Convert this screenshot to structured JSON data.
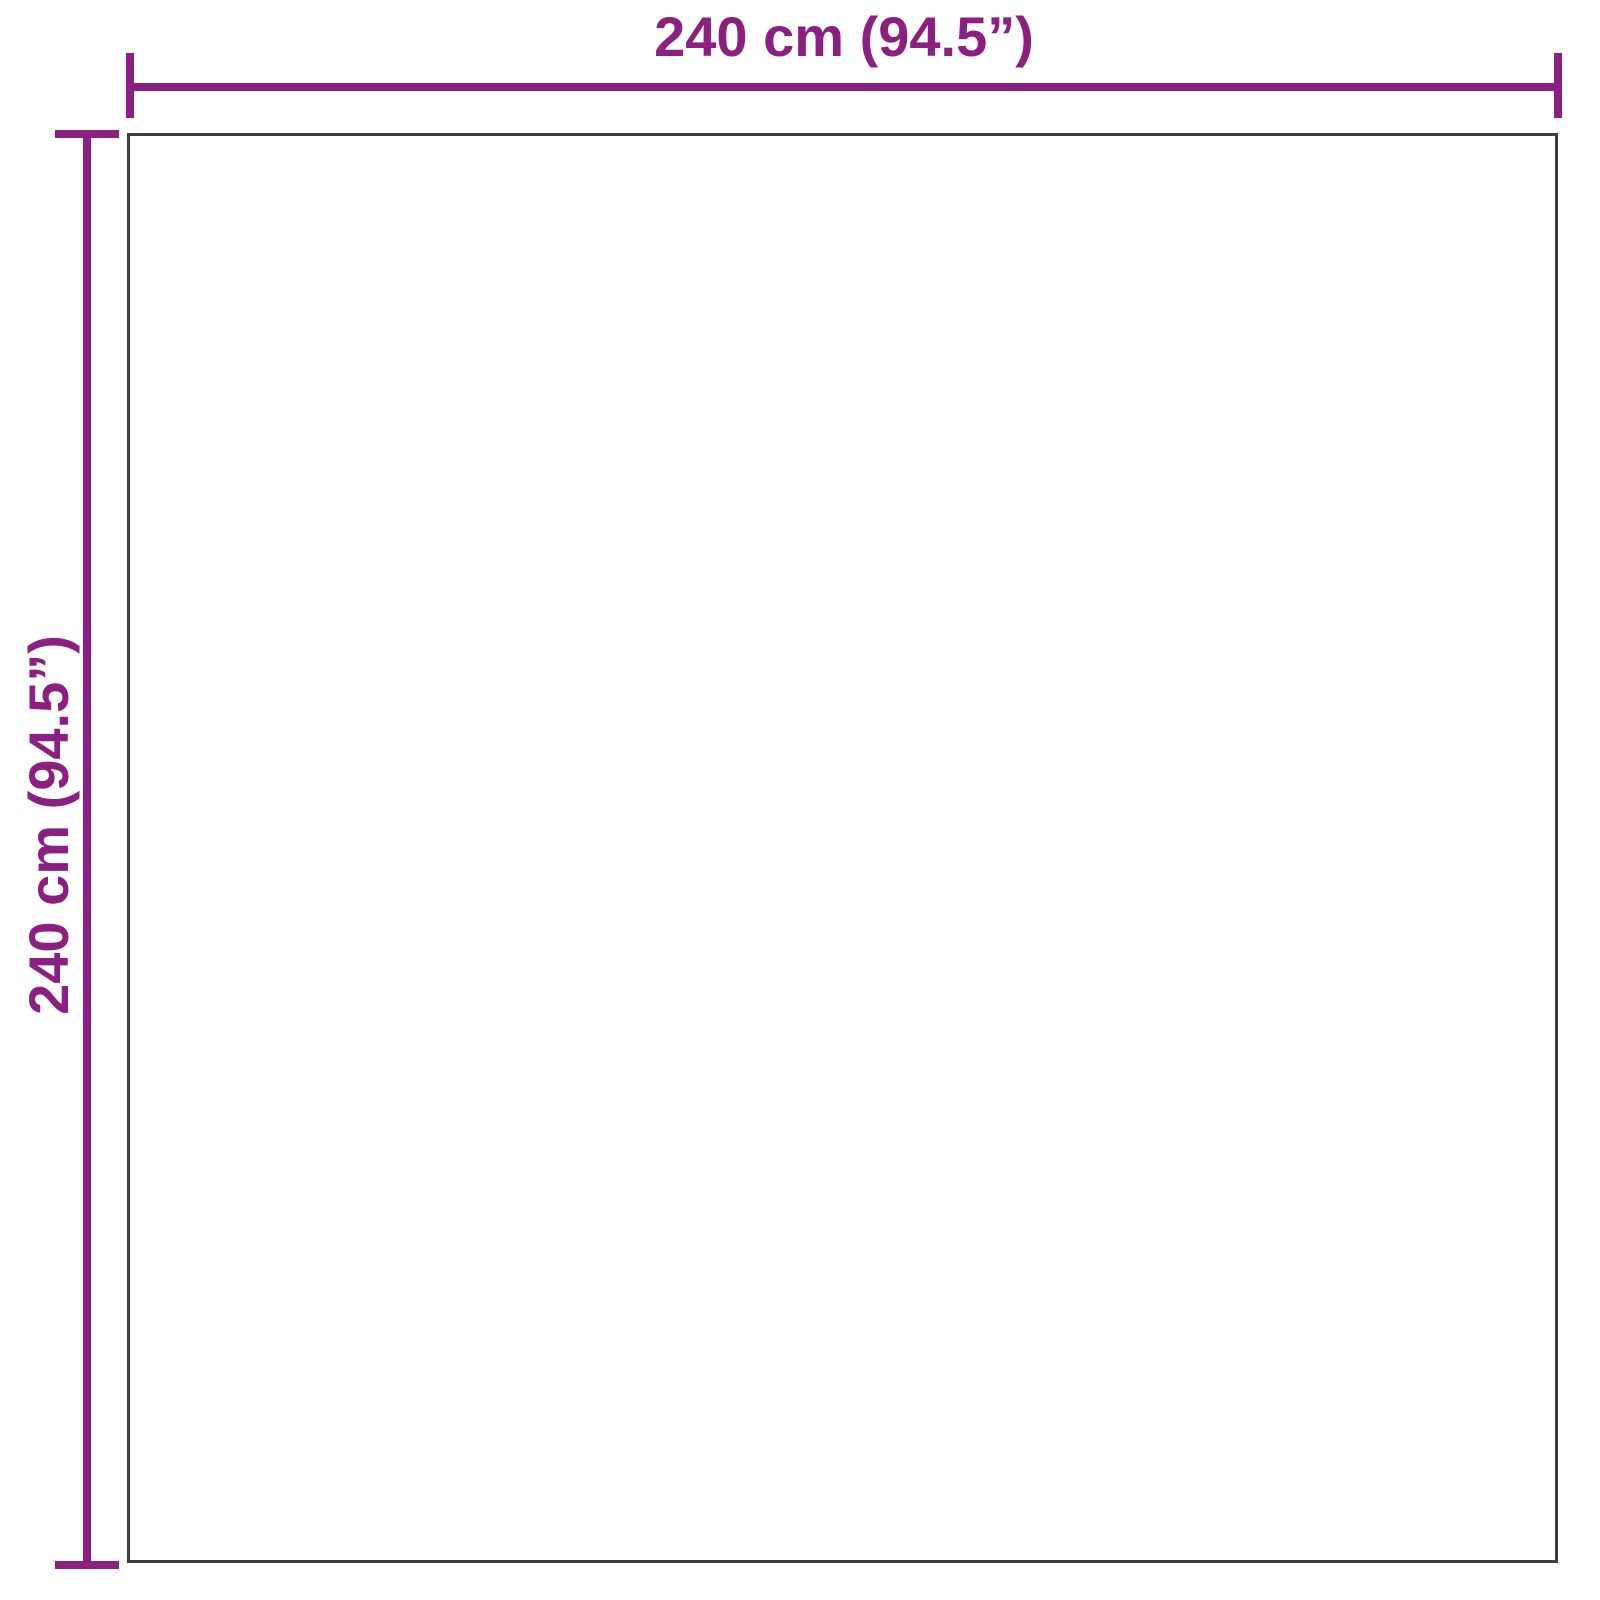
{
  "diagram": {
    "type": "product-dimension-diagram",
    "shape": "square",
    "width_label": "240 cm (94.5”)",
    "height_label": "240 cm (94.5”)",
    "width_cm": 240,
    "height_cm": 240,
    "width_inches": 94.5,
    "height_inches": 94.5
  },
  "colors": {
    "accent": "#8B2081",
    "outline": "#3D3D3D",
    "background": "#FFFFFF"
  }
}
